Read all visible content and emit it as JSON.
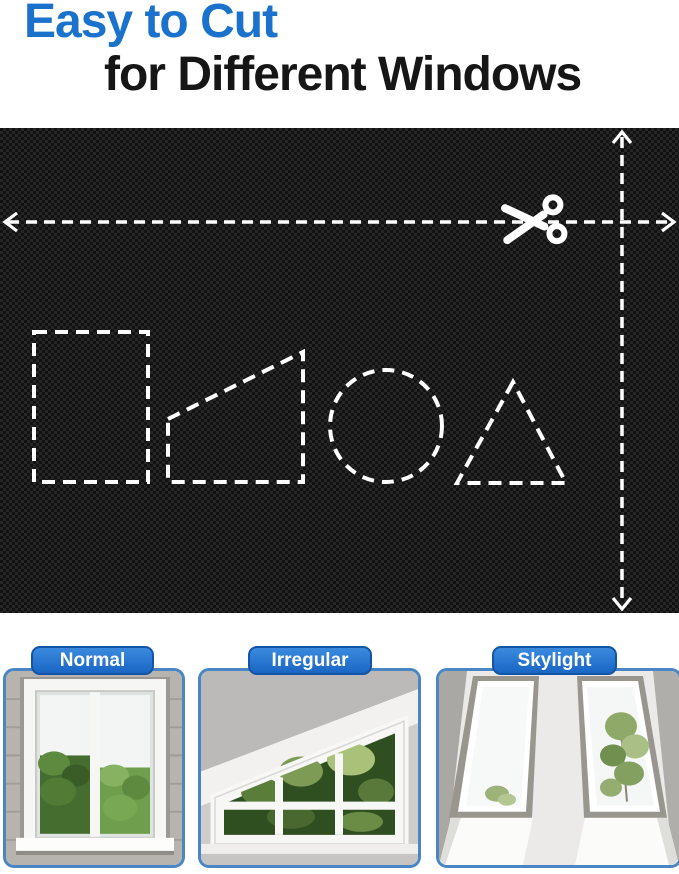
{
  "page": {
    "type": "product-infographic",
    "background_color": "#ffffff"
  },
  "header": {
    "title_line1": "Easy to Cut",
    "title_line2": "for Different Windows",
    "accent_color": "#1b72cc",
    "text_color": "#161616"
  },
  "fabric_panel": {
    "material": "black woven blackout fabric swatch",
    "base_color": "#1c1c1c",
    "guide_color": "#ffffff",
    "horizontal_cut_guide": "full-width dashed line with arrowheads at both ends and scissors",
    "vertical_cut_guide": "full-height dashed line with arrowheads at both ends",
    "cut_shapes": [
      "rectangle",
      "trapezoid",
      "circle",
      "triangle"
    ]
  },
  "window_cards": {
    "badge_color": "#1e6fce",
    "border_color": "#4a86c4",
    "items": [
      {
        "label": "Normal"
      },
      {
        "label": "Irregular"
      },
      {
        "label": "Skylight"
      }
    ]
  }
}
